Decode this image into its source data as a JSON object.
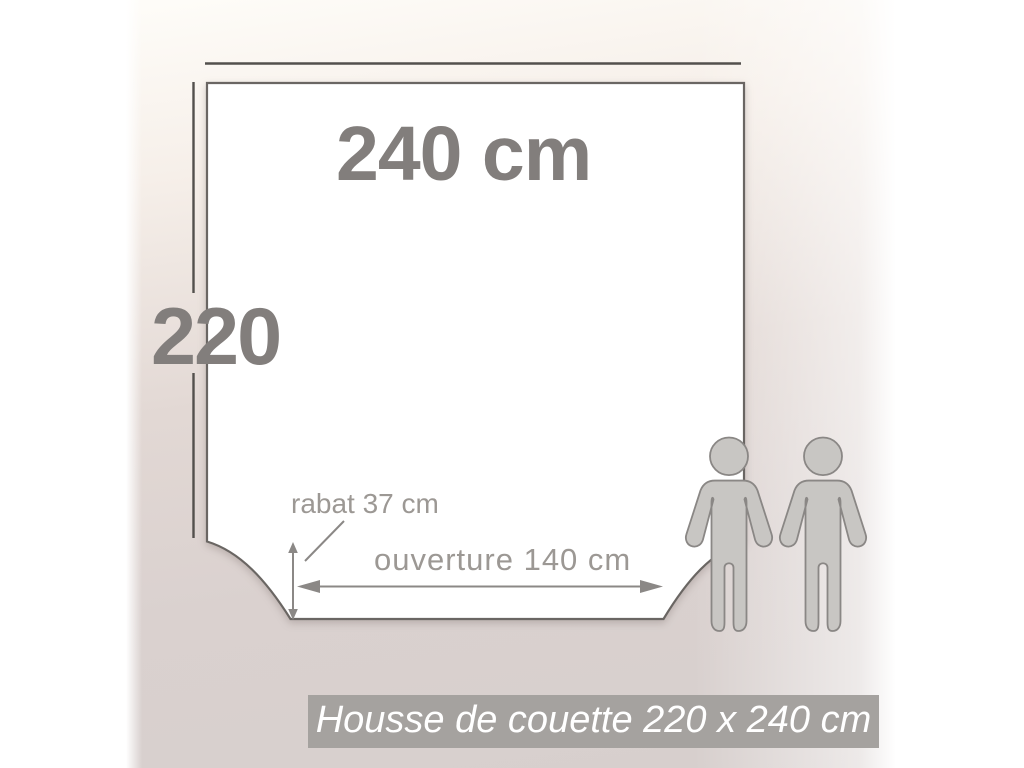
{
  "diagram": {
    "width_label": "240 cm",
    "height_label": "220",
    "flap_label": "rabat 37 cm",
    "opening_label": "ouverture 140 cm",
    "people_icon": "two-adults-standing-silhouette",
    "shape": "duvet-cover-square-with-scooped-bottom-corners"
  },
  "caption": "Housse de couette 220 x 240 cm",
  "colors": {
    "line-dark": "#53504d",
    "square-border": "#6a6663",
    "square-fill": "#ffffff",
    "big-text": "#827e7c",
    "small-text": "#9c9894",
    "arrow": "#8b8886",
    "banner-bg": "#a5a29f",
    "banner-text": "#ffffff",
    "person-fill": "#c8c6c3",
    "person-stroke": "#8a8785",
    "bg-taupe": "#d9d0ce",
    "bg-warm-white": "#fdf9f3"
  }
}
